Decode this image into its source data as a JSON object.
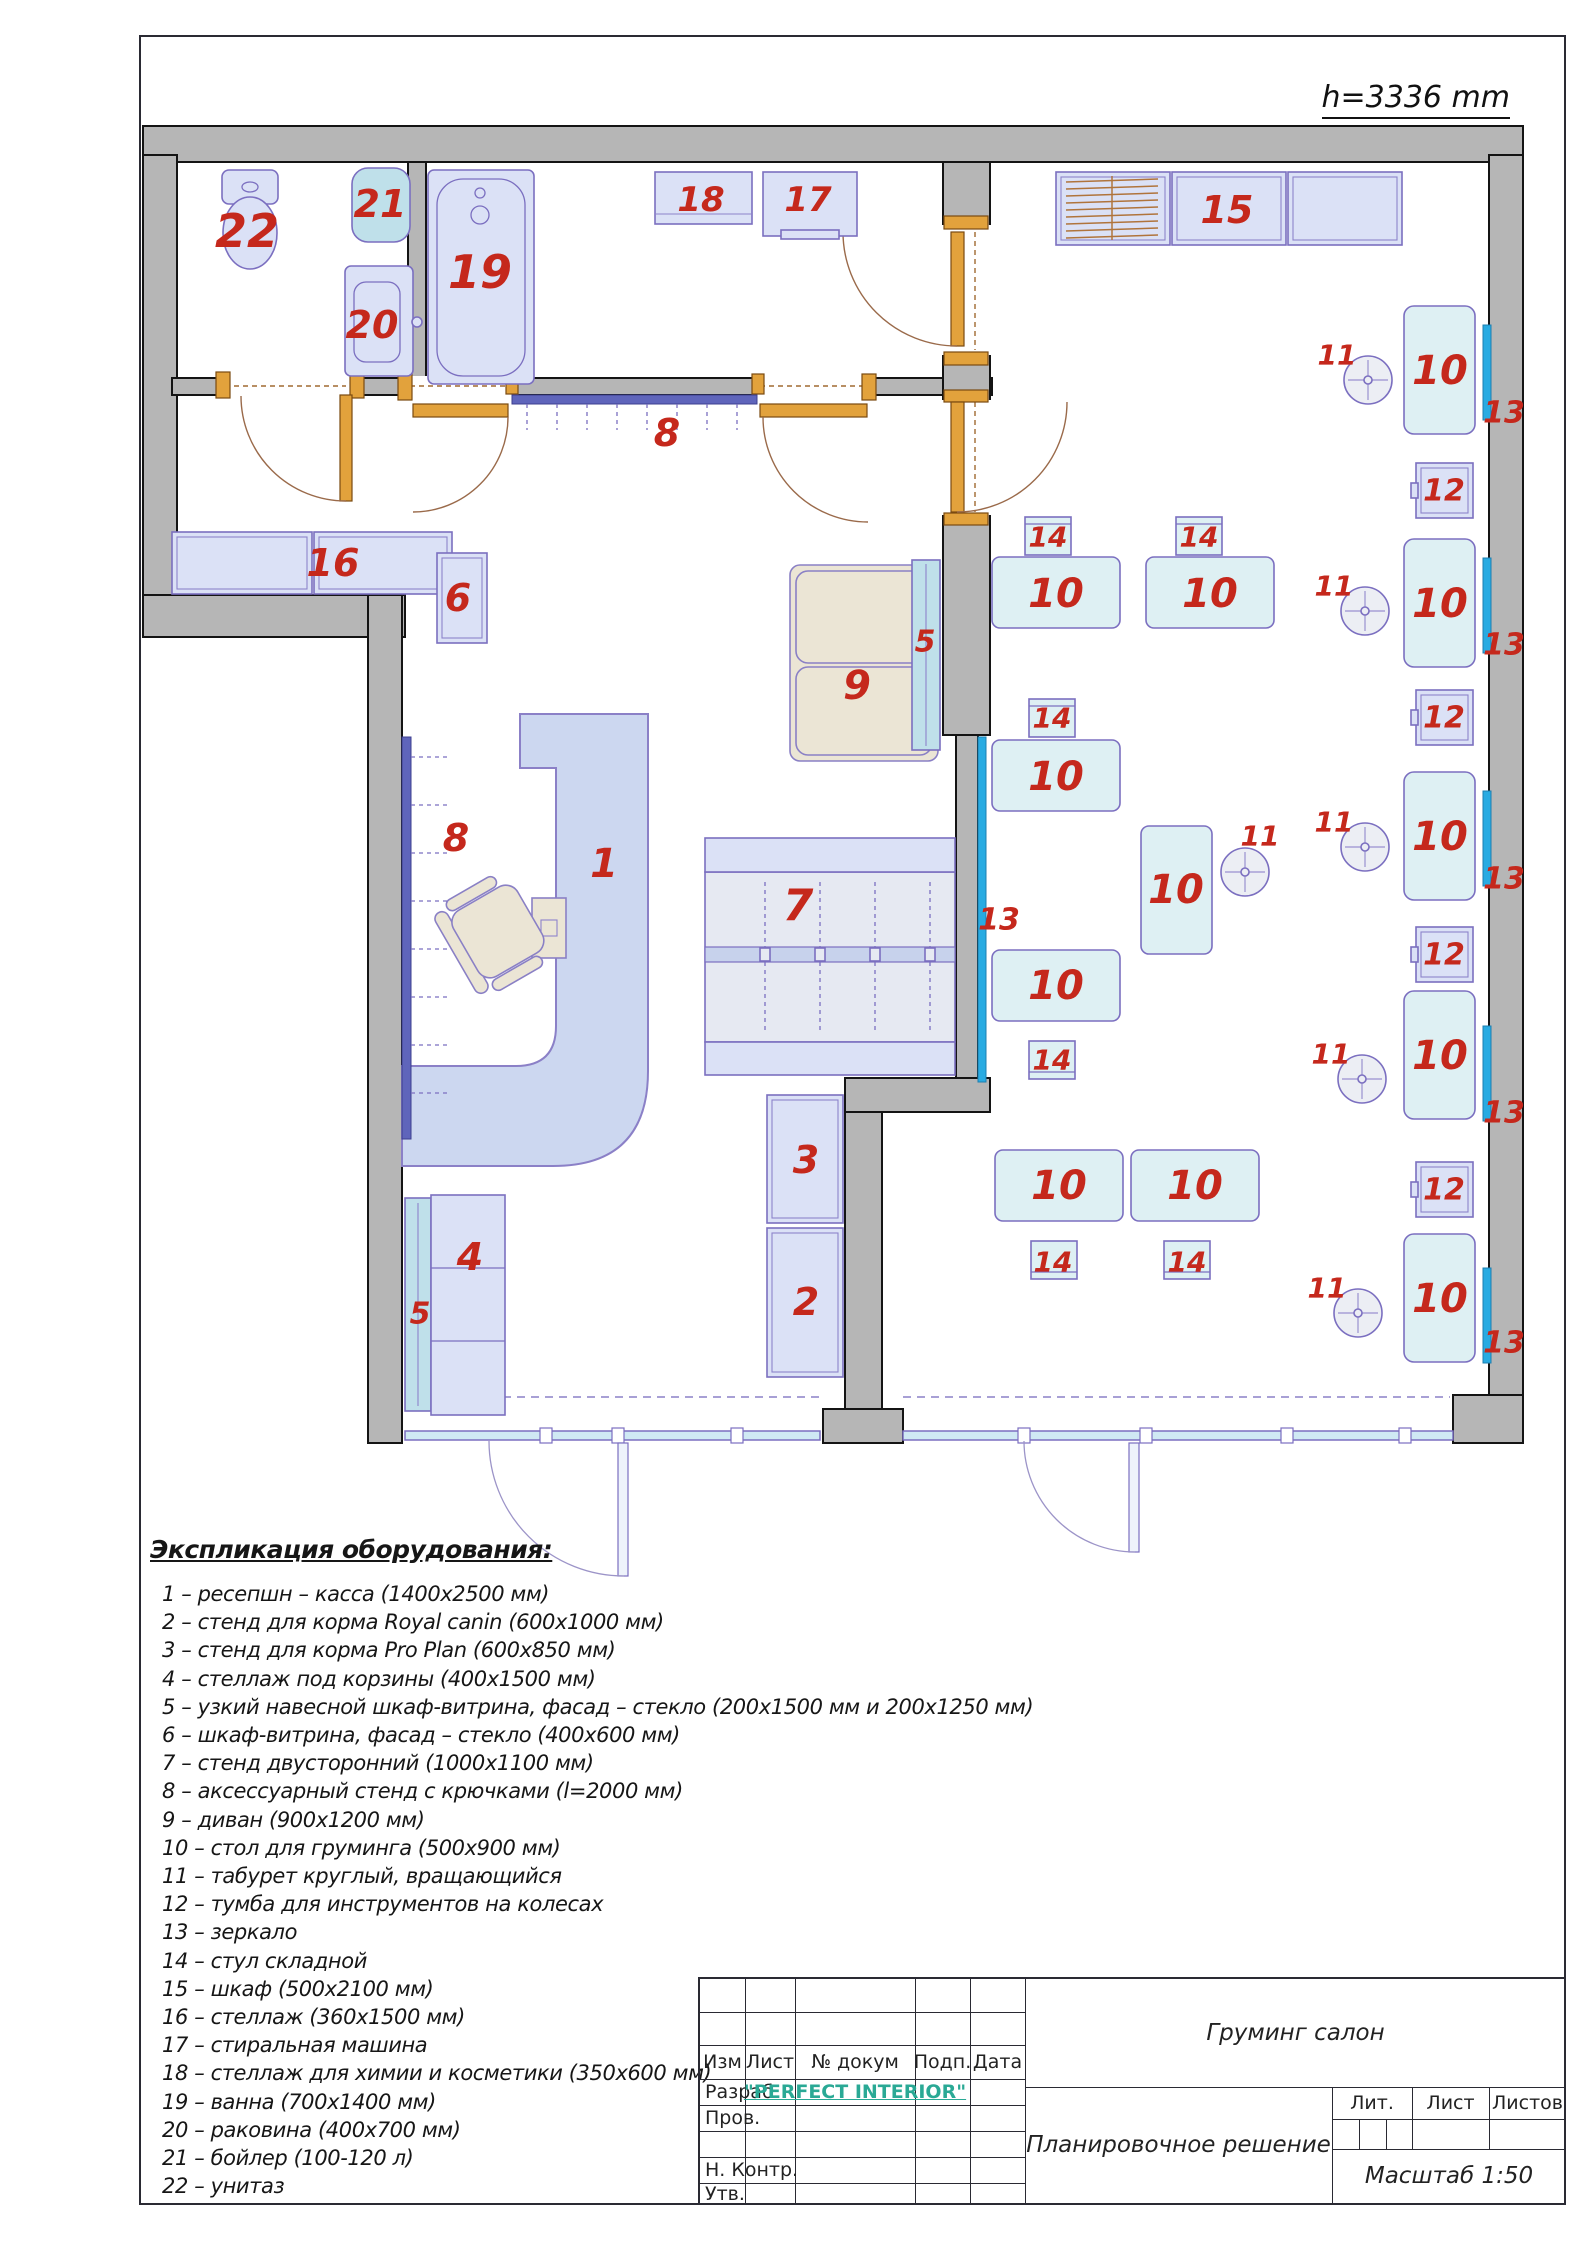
{
  "plan": {
    "height_note": "h=3336 mm",
    "colors": {
      "wall_gray": "#b6b6b6",
      "furniture_blue": "#dbe1f6",
      "grooming_cyan": "#def0f3",
      "display_teal": "#bfe0ea",
      "mirror_blue": "#29abe2",
      "door_wood": "#e2a23c",
      "label_red": "#c5281c",
      "beige": "#ebe5d5"
    },
    "labels": [
      [
        "22",
        247,
        231,
        46
      ],
      [
        "21",
        380,
        204,
        38
      ],
      [
        "20",
        372,
        325,
        38
      ],
      [
        "19",
        480,
        272,
        46
      ],
      [
        "18",
        701,
        200,
        34
      ],
      [
        "17",
        808,
        200,
        34
      ],
      [
        "15",
        1227,
        210,
        38
      ],
      [
        "8",
        667,
        433,
        38
      ],
      [
        "16",
        333,
        563,
        38
      ],
      [
        "6",
        458,
        598,
        38
      ],
      [
        "9",
        857,
        686,
        40
      ],
      [
        "5",
        925,
        642,
        30
      ],
      [
        "1",
        604,
        864,
        40
      ],
      [
        "8",
        456,
        838,
        38
      ],
      [
        "7",
        798,
        906,
        44
      ],
      [
        "13",
        999,
        920,
        30
      ],
      [
        "4",
        470,
        1257,
        38
      ],
      [
        "5",
        420,
        1314,
        30
      ],
      [
        "3",
        806,
        1160,
        38
      ],
      [
        "2",
        806,
        1302,
        38
      ],
      [
        "14",
        1048,
        537,
        28
      ],
      [
        "14",
        1199,
        537,
        28
      ],
      [
        "10",
        1056,
        594,
        40
      ],
      [
        "10",
        1210,
        594,
        40
      ],
      [
        "14",
        1052,
        718,
        28
      ],
      [
        "10",
        1056,
        777,
        40
      ],
      [
        "10",
        1176,
        890,
        40
      ],
      [
        "11",
        1260,
        836,
        28
      ],
      [
        "10",
        1056,
        986,
        40
      ],
      [
        "14",
        1052,
        1060,
        28
      ],
      [
        "10",
        1059,
        1186,
        40
      ],
      [
        "10",
        1195,
        1186,
        40
      ],
      [
        "14",
        1053,
        1262,
        28
      ],
      [
        "14",
        1187,
        1262,
        28
      ],
      [
        "11",
        1337,
        355,
        28
      ],
      [
        "10",
        1440,
        371,
        40
      ],
      [
        "13",
        1504,
        413,
        30
      ],
      [
        "12",
        1444,
        491,
        30
      ],
      [
        "11",
        1334,
        586,
        28
      ],
      [
        "10",
        1440,
        604,
        40
      ],
      [
        "13",
        1504,
        645,
        30
      ],
      [
        "12",
        1444,
        718,
        30
      ],
      [
        "11",
        1334,
        822,
        28
      ],
      [
        "10",
        1440,
        837,
        40
      ],
      [
        "13",
        1504,
        879,
        30
      ],
      [
        "12",
        1444,
        955,
        30
      ],
      [
        "11",
        1331,
        1054,
        28
      ],
      [
        "10",
        1440,
        1056,
        40
      ],
      [
        "13",
        1504,
        1113,
        30
      ],
      [
        "12",
        1444,
        1190,
        30
      ],
      [
        "11",
        1327,
        1288,
        28
      ],
      [
        "10",
        1440,
        1299,
        40
      ],
      [
        "13",
        1504,
        1343,
        30
      ]
    ]
  },
  "legend": {
    "title": "Экспликация оборудования:",
    "items": [
      "1 – ресепшн – касса (1400х2500 мм)",
      "2 – стенд для корма Royal canin (600х1000 мм)",
      "3 – стенд для корма Pro Plan (600х850 мм)",
      "4 – стеллаж под корзины (400х1500 мм)",
      "5 – узкий навесной шкаф-витрина, фасад – стекло (200х1500 мм и 200х1250 мм)",
      "6 – шкаф-витрина, фасад – стекло (400х600 мм)",
      "7 – стенд двусторонний (1000х1100 мм)",
      "8 – аксессуарный стенд с крючками (l=2000 мм)",
      "9 – диван (900х1200 мм)",
      "10 – стол для груминга (500х900 мм)",
      "11 – табурет круглый, вращающийся",
      "12 – тумба для инструментов на колесах",
      "13 – зеркало",
      "14 – стул складной",
      "15 – шкаф (500х2100 мм)",
      "16 – стеллаж (360х1500 мм)",
      "17 – стиральная машина",
      "18 – стеллаж для химии и косметики (350х600 мм)",
      "19 – ванна (700х1400 мм)",
      "20 – раковина (400х700 мм)",
      "21 – бойлер (100-120 л)",
      "22 – унитаз"
    ]
  },
  "title_block": {
    "columns": [
      "Изм",
      "Лист",
      "№ докум",
      "Подп.",
      "Дата"
    ],
    "stamp_rows": [
      "Разраб.",
      "Пров.",
      "Н. Контр.",
      "Утв."
    ],
    "developer_value": "\"PERFECT INTERIOR\"",
    "project_title": "Груминг салон",
    "sheet_title": "Планировочное решение",
    "scale_label": "Масштаб 1:50",
    "lit_headers": [
      "Лит.",
      "Лист",
      "Листов"
    ]
  }
}
